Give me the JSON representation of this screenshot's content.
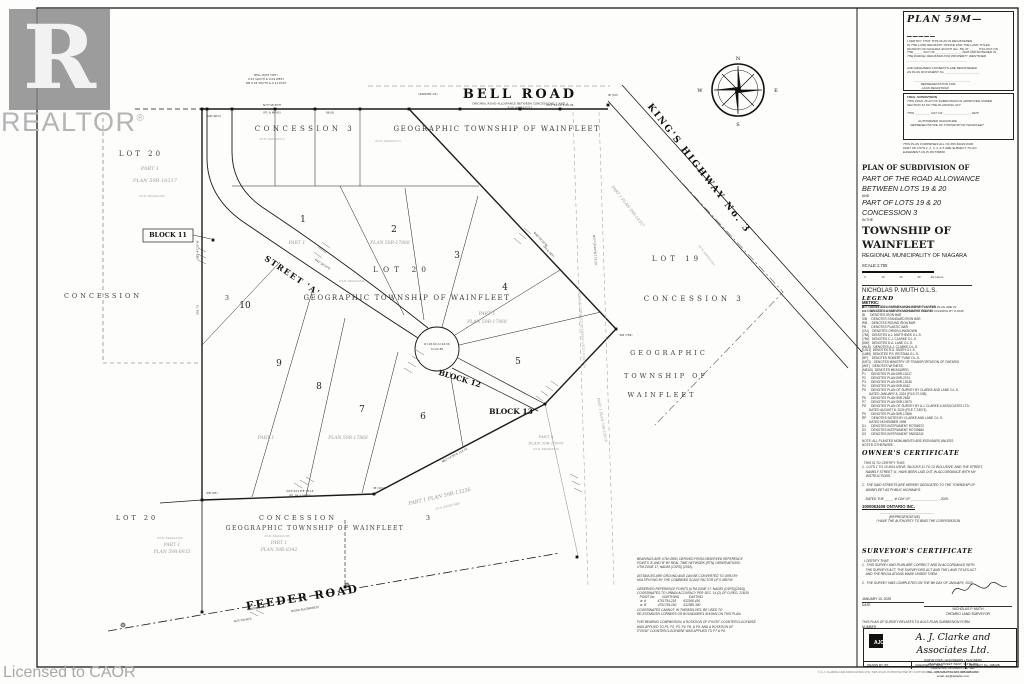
{
  "watermark": {
    "logo_letter": "R",
    "brand": "REALTOR",
    "registered": "®",
    "license": "Licensed to CAOR"
  },
  "registration_panel": {
    "title": "PLAN  59M—_____",
    "lines": [
      "I CERTIFY THAT THIS PLAN IS REGISTERED",
      "IN THE LAND REGISTRY OFFICE FOR THE LAND TITLES",
      "DIVISION OF NIAGARA SOUTH (No. 59) AT _____ O'CLOCK ON",
      "THE _____ DAY OF ______________ , 2025 AND ENTERED IN",
      "THE PARCEL REGISTER FOR PROPERTY IDENTIFIER",
      "___________________________________",
      "",
      "AND REQUIRED CONSENTS ARE REGISTERED",
      "AS PLAN DOCUMENT No. ____________________",
      "",
      "        _________________________________",
      "                REPRESENTATIVE FOR",
      "                 LAND REGISTRAR"
    ]
  },
  "approval_panel": {
    "heading": "FINAL SUBDIVISION",
    "lines": [
      "THIS FINAL PLAN OF SUBDIVISION IS APPROVED UNDER",
      "SECTION 51 OF THE PLANNING ACT.",
      "",
      "THIS _________ DAY OF _______________ , 2025",
      "",
      "             AUTHORIZED SIGNATURE",
      "    REPRESENTATIVE OF TOWNSHIP OF WAINFLEET"
    ]
  },
  "pin_note": [
    "THIS PLAN COMPRISES ALL OF PIN 64029-0306.",
    "PART OF LOTS 1, 2, 3, 4, & 5 ARE SUBJECT TO AN",
    "EASEMENT AS IN RO739660."
  ],
  "title_block": {
    "line1": "PLAN  OF  SUBDIVISION  OF",
    "line2": "PART OF THE ROAD ALLOWANCE",
    "line3": "BETWEEN LOTS 19 & 20",
    "line4": "AND",
    "line5": "PART OF LOTS 19 & 20",
    "line6": "CONCESSION 3",
    "line7": "IN THE",
    "line8": "TOWNSHIP  OF  WAINFLEET",
    "line9": "REGIONAL MUNICIPALITY OF NIAGARA",
    "scale": "SCALE 1:750",
    "scale_ticks": [
      "0",
      "10",
      "20",
      "30",
      "40 metres"
    ],
    "surveyor": "NICHOLAS P. MUTH  O.L.S.",
    "metric_heading": "METRIC:",
    "metric_lines": [
      "DISTANCES AND COORDINATES SHOWN ON THIS PLAN ARE IN",
      "METRES AND CAN BE CONVERTED TO FEET BY DIVIDING BY 0.3048"
    ]
  },
  "legend": {
    "heading": "LEGEND",
    "entries": [
      "■       DENOTES A SURVEY MONUMENT PLANTED",
      "□       DENOTES A SURVEY MONUMENT FOUND",
      "IB      DENOTES IRON BAR",
      "SIB     DENOTES STANDARD IRON BAR",
      "RIB     DENOTES ROUND IRON BAR",
      "PB      DENOTES PLASTIC BAR",
      "(OU)    DENOTES ORIGIN UNKNOWN",
      "(784)   DENOTES A.J. MATTHEWS O.L.S.",
      "(759)   DENOTES C.J. CLARKE O.L.S.",
      "(800)   DENOTES D.A. LANE O.L.S.",
      "(WLS)   DENOTES A.J. CLARKE O.L.S.",
      "(1021)  DENOTES R.D. SMITH O.L.S.",
      "(1485)  DENOTES P.E. REITSMA O.L.S.",
      "(RF)    DENOTES ROBERT FUNK O.L.S.",
      "(MTO)   DENOTES MINISTRY OF TRANSPORTATION OF ONTARIO",
      "(WIT)   DENOTES WITNESS",
      "(MEAS)  DENOTES MEASURED",
      "P1      DENOTES PLAN 59R-10217",
      "P2      DENOTES PLAN 59R-2074",
      "P3      DENOTES PLAN 59R-13236",
      "P4      DENOTES PLAN 59R-8342",
      "P5      DENOTES PLAN OF SURVEY BY CLARKE AND LANE O.L.S.",
      "        DATED JANUARY 8, 2024 (FILE 97-038)",
      "P6      DENOTES PLAN 59R-2638",
      "P7      DENOTES PLAN 59R-13970",
      "P8      DENOTES PLAN OF SURVEY BY A.J. CLARKE & ASSOCIATES LTD.",
      "        DATED AUGUST 8, 2024 (FILE T-23074)",
      "P9      DENOTES PLAN 59R-17868",
      "RP      DENOTES NOTES BY CLARKE AND LANE O.L.S.",
      "        DATED NOVEMBER 1998",
      "D1      DENOTES INSTRUMENT RO758372",
      "D2      DENOTES INSTRUMENT RO739660",
      "D3      DENOTES INSTRUMENT SN532242"
    ],
    "note": "NOTE: ALL PLANTED MONUMENTS ARE IRON BARS UNLESS\nNOTED OTHERWISE."
  },
  "owners_certificate": {
    "heading": "OWNER'S  CERTIFICATE",
    "lines": [
      "  THIS IS TO CERTIFY THAT:",
      "1.  LOTS 1 TO 10 INCLUSIVE, BLOCKS 11 TO 13 INCLUSIVE, AND THE STREET,",
      "    NAMELY STREET 'A', HAVE BEEN LAID OUT IN ACCORDANCE WITH MY",
      "    INSTRUCTIONS.",
      "",
      "2.  THE SAID STREETS ARE HEREBY DEDICATED TO THE TOWNSHIP OF",
      "    WAINFLEET AS PUBLIC HIGHWAYS.",
      "",
      "    DATED THE _____ th DAY OF _______________ , 2025."
    ],
    "owner": "1000063408 ONTARIO INC.",
    "rep_lines": [
      "                    ______________________________",
      "                              (REPRESENTATIVE)",
      "                I HAVE THE AUTHORITY TO BIND THE CORPORATION"
    ]
  },
  "surveyors_certificate": {
    "heading": "SURVEYOR'S  CERTIFICATE",
    "lines": [
      "  I CERTIFY THAT:",
      "1.  THIS SURVEY AND PLAN ARE CORRECT AND IN ACCORDANCE WITH",
      "    THE SURVEYS ACT, THE SURVEYORS ACT AND THE LAND TITLES ACT",
      "    AND THE REGULATIONS MADE UNDER THEM.",
      "",
      "2.  THE SURVEY WAS COMPLETED ON THE 9th DAY OF JANUARY, 2025."
    ],
    "date_value": "JANUARY 10, 2025",
    "date_label": "DATE",
    "signer_name": "NICHOLAS P. MUTH",
    "signer_title": "ONTARIO LAND SURVEYOR",
    "closing_lines": [
      "THIS PLAN OF SURVEY RELATES TO AOLS PLAN SUBMISSION FORM",
      "NUMBER ___________________"
    ]
  },
  "firm": {
    "monogram": "AJC",
    "name": "A. J. Clarke and Associates Ltd.",
    "tagline": "SURVEYORS  •  ENGINEERS  •  PLANNERS",
    "address1": "25 MAIN STREET WEST, SUITE 300",
    "address2": "HAMILTON, ONTARIO, L8P 1H1",
    "phone": "TEL:  905-528-8761      FAX  905-528-2099",
    "email": "email: ajc@ajclarke.com",
    "drawn_by": "DRAWN BY:  BT",
    "checked_by": "CHECKED BY:  NPM",
    "project_no": "PROJECT No.  19822B"
  },
  "copyright": "© A.J. CLARKE AND ASSOCIATES LTD.  THIS PLAN IS PROTECTED BY COPYRIGHT — 2025  ALL RIGHTS RESERVED",
  "notes_block": {
    "lines": [
      "BEARINGS ARE UTM GRID, DERIVED FROM OBSERVED REFERENCE",
      "POINTS 'A' AND 'B' BY REAL TIME NETWORK (RTN) OBSERVATIONS,",
      "UTM ZONE 17, NAD83 (CSRS) (2010).",
      "",
      "DISTANCES ARE GROUND AND CAN BE CONVERTED TO GRID BY",
      "MULTIPLYING BY THE COMBINED SCALE FACTOR OF 0.999740",
      "",
      "OBSERVED REFERENCE POINTS (UTM ZONE 17, NAD83 (CSRS)(2010))",
      "COORDINATES TO URBAN ACCURACY PER SEC. 14 (2) OF O.REG. 216/10",
      "   POINT No.        NORTHING           EASTING",
      "   ⊕  A             4751754.218        632268.416",
      "   ⊕  B             4751754.160        632080.340",
      "COORDINATES CANNOT, IN THEMSELVES, BE USED TO",
      "RE-ESTABLISH CORNERS OR BOUNDARIES SHOWN ON THIS PLAN.",
      "",
      "FOR BEARING COMPARISON, A ROTATION OF 0°04'30\" COUNTERCLOCKWISE",
      "WAS APPLIED TO P1, P2, P3, P4, P6, & P9, AND A ROTATION OF",
      "0°09'40\" COUNTERCLOCKWISE WAS APPLIED TO P7 & P8."
    ]
  },
  "compass": {
    "n": "N",
    "e": "E",
    "s": "S",
    "w": "W"
  },
  "map": {
    "area_labels": [
      {
        "t": "LOT  20",
        "x": 141,
        "y": 156,
        "fs": 7,
        "ls": 3
      },
      {
        "t": "CONCESSION",
        "x": 103,
        "y": 298,
        "fs": 6.5,
        "ls": 3
      },
      {
        "t": "3",
        "x": 227,
        "y": 300,
        "fs": 6.5,
        "ls": 0
      },
      {
        "t": "CONCESSION  3",
        "x": 305,
        "y": 131,
        "fs": 7,
        "ls": 3.5
      },
      {
        "t": "GEOGRAPHIC  TOWNSHIP  OF  WAINFLEET",
        "x": 497,
        "y": 131,
        "fs": 7,
        "ls": 1.6
      },
      {
        "t": "LOT   20",
        "x": 402,
        "y": 272,
        "fs": 7.5,
        "ls": 5
      },
      {
        "t": "GEOGRAPHIC  TOWNSHIP  OF  WAINFLEET",
        "x": 407,
        "y": 300,
        "fs": 7,
        "ls": 1.6
      },
      {
        "t": "LOT  19",
        "x": 677,
        "y": 261,
        "fs": 7,
        "ls": 4
      },
      {
        "t": "CONCESSION  3",
        "x": 694,
        "y": 301,
        "fs": 7,
        "ls": 3.5
      },
      {
        "t": "GEOGRAPHIC",
        "x": 669,
        "y": 355,
        "fs": 6.5,
        "ls": 3
      },
      {
        "t": "TOWNSHIP  OF",
        "x": 666,
        "y": 378,
        "fs": 6.5,
        "ls": 3
      },
      {
        "t": "WAINFLEET",
        "x": 662,
        "y": 397,
        "fs": 6.5,
        "ls": 3
      },
      {
        "t": "LOT  20",
        "x": 137,
        "y": 520,
        "fs": 6.5,
        "ls": 3
      },
      {
        "t": "CONCESSION",
        "x": 298,
        "y": 520,
        "fs": 6.5,
        "ls": 3
      },
      {
        "t": "3",
        "x": 428,
        "y": 520,
        "fs": 6.5,
        "ls": 0
      },
      {
        "t": "GEOGRAPHIC  TOWNSHIP  OF  WAINFLEET",
        "x": 315,
        "y": 530,
        "fs": 6,
        "ls": 1.4
      }
    ],
    "road_labels": [
      {
        "t": "BELL  ROAD",
        "x": 520,
        "y": 98,
        "fs": 13,
        "ls": 3
      },
      {
        "t": "KING'S  HIGHWAY  No. 3",
        "x": 697,
        "y": 170,
        "fs": 9,
        "ls": 2,
        "rot": 52
      },
      {
        "t": "FEEDER  ROAD",
        "x": 303,
        "y": 601,
        "fs": 11,
        "ls": 2,
        "rot": -9
      },
      {
        "t": "STREET  'A'",
        "x": 291,
        "y": 278,
        "fs": 8,
        "ls": 1.5,
        "rot": 34
      }
    ],
    "road_sublabels": [
      {
        "t": "(KNOWN AS)",
        "x": 428,
        "y": 95,
        "fs": 3
      },
      {
        "t": "ORIGINAL ROAD ALLOWANCE BETWEEN CONCESSIONS 2 AND 3",
        "x": 520,
        "y": 104.5,
        "fs": 3
      },
      {
        "t": "P.I.N. 64029-0711",
        "x": 520,
        "y": 108.6,
        "fs": 2.8
      },
      {
        "t": "(KNOWN AS)",
        "x": 257,
        "y": 609,
        "fs": 3,
        "rot": -9
      },
      {
        "t": "(ROAD ALLOWANCE)",
        "x": 305,
        "y": 610,
        "fs": 2.8,
        "rot": -9
      }
    ],
    "block_labels": [
      {
        "t": "BLOCK  11",
        "x": 168,
        "y": 237,
        "fs": 6.5
      },
      {
        "t": "BLOCK  12",
        "x": 459,
        "y": 381,
        "fs": 7.5,
        "rot": 17
      },
      {
        "t": "BLOCK  13",
        "x": 511,
        "y": 414,
        "fs": 7.5
      }
    ],
    "lot_numbers": [
      {
        "t": "1",
        "x": 303,
        "y": 222
      },
      {
        "t": "2",
        "x": 394,
        "y": 232
      },
      {
        "t": "3",
        "x": 457,
        "y": 258
      },
      {
        "t": "4",
        "x": 505,
        "y": 290
      },
      {
        "t": "5",
        "x": 518,
        "y": 364
      },
      {
        "t": "6",
        "x": 423,
        "y": 419
      },
      {
        "t": "7",
        "x": 362,
        "y": 412
      },
      {
        "t": "8",
        "x": 319,
        "y": 389
      },
      {
        "t": "9",
        "x": 279,
        "y": 366
      },
      {
        "t": "10",
        "x": 245,
        "y": 308
      }
    ],
    "faint_labels": [
      {
        "t": "PART 1",
        "x": 150,
        "y": 170,
        "fs": 5
      },
      {
        "t": "PLAN 59R-10217",
        "x": 155,
        "y": 182,
        "fs": 5
      },
      {
        "t": "P.I.N. 64029-0192",
        "x": 152,
        "y": 197,
        "fs": 2.8
      },
      {
        "t": "PART 1",
        "x": 297,
        "y": 244,
        "fs": 4.5
      },
      {
        "t": "PLAN 59R-17868",
        "x": 390,
        "y": 244,
        "fs": 4.5
      },
      {
        "t": "PART 1",
        "x": 487,
        "y": 315,
        "fs": 4.5
      },
      {
        "t": "PLAN 59R-17868",
        "x": 487,
        "y": 323,
        "fs": 4.5
      },
      {
        "t": "PART 1",
        "x": 266,
        "y": 439,
        "fs": 4.5
      },
      {
        "t": "PLAN 59R-17868",
        "x": 348,
        "y": 439,
        "fs": 4.5
      },
      {
        "t": "PART 1   PLAN 59R-13236",
        "x": 440,
        "y": 498,
        "fs": 5,
        "rot": -13
      },
      {
        "t": "P.I.N. 64029-0600",
        "x": 448,
        "y": 507,
        "fs": 2.8,
        "rot": -13
      },
      {
        "t": "PART 6",
        "x": 546,
        "y": 438,
        "fs": 4
      },
      {
        "t": "PLAN 59R-13970",
        "x": 546,
        "y": 444.5,
        "fs": 4
      },
      {
        "t": "P.I.N. 64029-0470",
        "x": 546,
        "y": 450,
        "fs": 2.8
      },
      {
        "t": "PART 1  PLAN 59R-14557",
        "x": 627,
        "y": 207,
        "fs": 4,
        "rot": 52
      },
      {
        "t": "P.I.N. 64029-0194",
        "x": 170,
        "y": 539,
        "fs": 2.8
      },
      {
        "t": "PART 1",
        "x": 172,
        "y": 546,
        "fs": 4.5
      },
      {
        "t": "PLAN 59R-8935",
        "x": 172,
        "y": 553,
        "fs": 4.5
      },
      {
        "t": "P.I.N. 64029-0195",
        "x": 277,
        "y": 537,
        "fs": 2.8
      },
      {
        "t": "PART 1",
        "x": 279,
        "y": 544,
        "fs": 4.5
      },
      {
        "t": "PLAN 59R-8342",
        "x": 279,
        "y": 551,
        "fs": 4.5
      },
      {
        "t": "P.I.N. 64029-0712",
        "x": 272,
        "y": 140,
        "fs": 2.8
      },
      {
        "t": "P.I.N. 64029-0713",
        "x": 388,
        "y": 142,
        "fs": 2.8
      },
      {
        "t": "P.I.N. 64029-0306",
        "x": 352,
        "y": 282,
        "fs": 2.8
      },
      {
        "t": "P.I.N. 64029-0321",
        "x": 706,
        "y": 256,
        "fs": 2.8,
        "rot": 52
      },
      {
        "t": "ROAD ALLOWANCE BETWEEN LOTS 19 AND 20",
        "x": 581,
        "y": 330,
        "fs": 3,
        "rot": 86
      },
      {
        "t": "PART 1  PLAN 59R-13970",
        "x": 601,
        "y": 420,
        "fs": 3.5,
        "rot": 80
      }
    ],
    "micro_labels": [
      {
        "t": "N73°46'30\"E",
        "x": 272,
        "y": 106
      },
      {
        "t": "(P1 & MEAS)",
        "x": 272,
        "y": 113.5
      },
      {
        "t": "86.06",
        "x": 330,
        "y": 113.5
      },
      {
        "t": "N73°54'40\"E  60.96",
        "x": 560,
        "y": 106
      },
      {
        "t": "SIB (WLS)",
        "x": 214,
        "y": 117
      },
      {
        "t": "IB (OU)",
        "x": 613,
        "y": 96
      },
      {
        "t": "BELL POST (WIT)",
        "x": 266,
        "y": 76
      },
      {
        "t": "0.15 SOUTH & 0.09 WEST",
        "x": 266,
        "y": 80
      },
      {
        "t": "SIB 0.18 SOUTH & 0.12 EAST",
        "x": 266,
        "y": 84
      },
      {
        "t": "N16°47'20\"W",
        "x": 198.5,
        "y": 250,
        "rot": -90
      },
      {
        "t": "155.73",
        "x": 198.5,
        "y": 310,
        "rot": -90
      },
      {
        "t": "N42°36'10\"E",
        "x": 322,
        "y": 265,
        "rot": 33
      },
      {
        "t": "R=18.00  A=24.56",
        "x": 437,
        "y": 345
      },
      {
        "t": "C=22.80",
        "x": 437,
        "y": 350
      },
      {
        "t": "N46°02'30\"W",
        "x": 540,
        "y": 240,
        "rot": 47
      },
      {
        "t": "(P9 & SET)",
        "x": 548,
        "y": 252,
        "rot": 47
      },
      {
        "t": "N62°14'50\"E  114.52",
        "x": 455,
        "y": 456,
        "rot": -28
      },
      {
        "t": "N73°22'10\"E  73.15",
        "x": 300,
        "y": 492
      },
      {
        "t": "(P3, P4 & MEAS)",
        "x": 300,
        "y": 496.5
      },
      {
        "t": "SIB (784)",
        "x": 626,
        "y": 336
      },
      {
        "t": "IB (1021)",
        "x": 380,
        "y": 489
      },
      {
        "t": "SIB (RF)",
        "x": 212,
        "y": 494
      },
      {
        "t": "N73°50'40\"E",
        "x": 243,
        "y": 621,
        "rot": -9
      },
      {
        "t": "N17°10'40\"W  172.24",
        "x": 594,
        "y": 250,
        "rot": 86
      }
    ],
    "monuments": [
      {
        "x": 202,
        "y": 109
      },
      {
        "x": 207,
        "y": 109
      },
      {
        "x": 232,
        "y": 109
      },
      {
        "x": 275,
        "y": 109
      },
      {
        "x": 315,
        "y": 109
      },
      {
        "x": 360,
        "y": 109
      },
      {
        "x": 409,
        "y": 109
      },
      {
        "x": 460,
        "y": 109
      },
      {
        "x": 520,
        "y": 109
      },
      {
        "x": 560,
        "y": 109
      },
      {
        "x": 608,
        "y": 105
      },
      {
        "x": 616,
        "y": 329
      },
      {
        "x": 545,
        "y": 404
      },
      {
        "x": 374,
        "y": 494
      },
      {
        "x": 202,
        "y": 500
      },
      {
        "x": 202,
        "y": 612
      },
      {
        "x": 345,
        "y": 587
      },
      {
        "x": 577,
        "y": 557
      },
      {
        "x": 213,
        "y": 240
      }
    ],
    "orp_points": [
      {
        "x": 123,
        "y": 625
      },
      {
        "x": 347,
        "y": 585
      }
    ]
  }
}
